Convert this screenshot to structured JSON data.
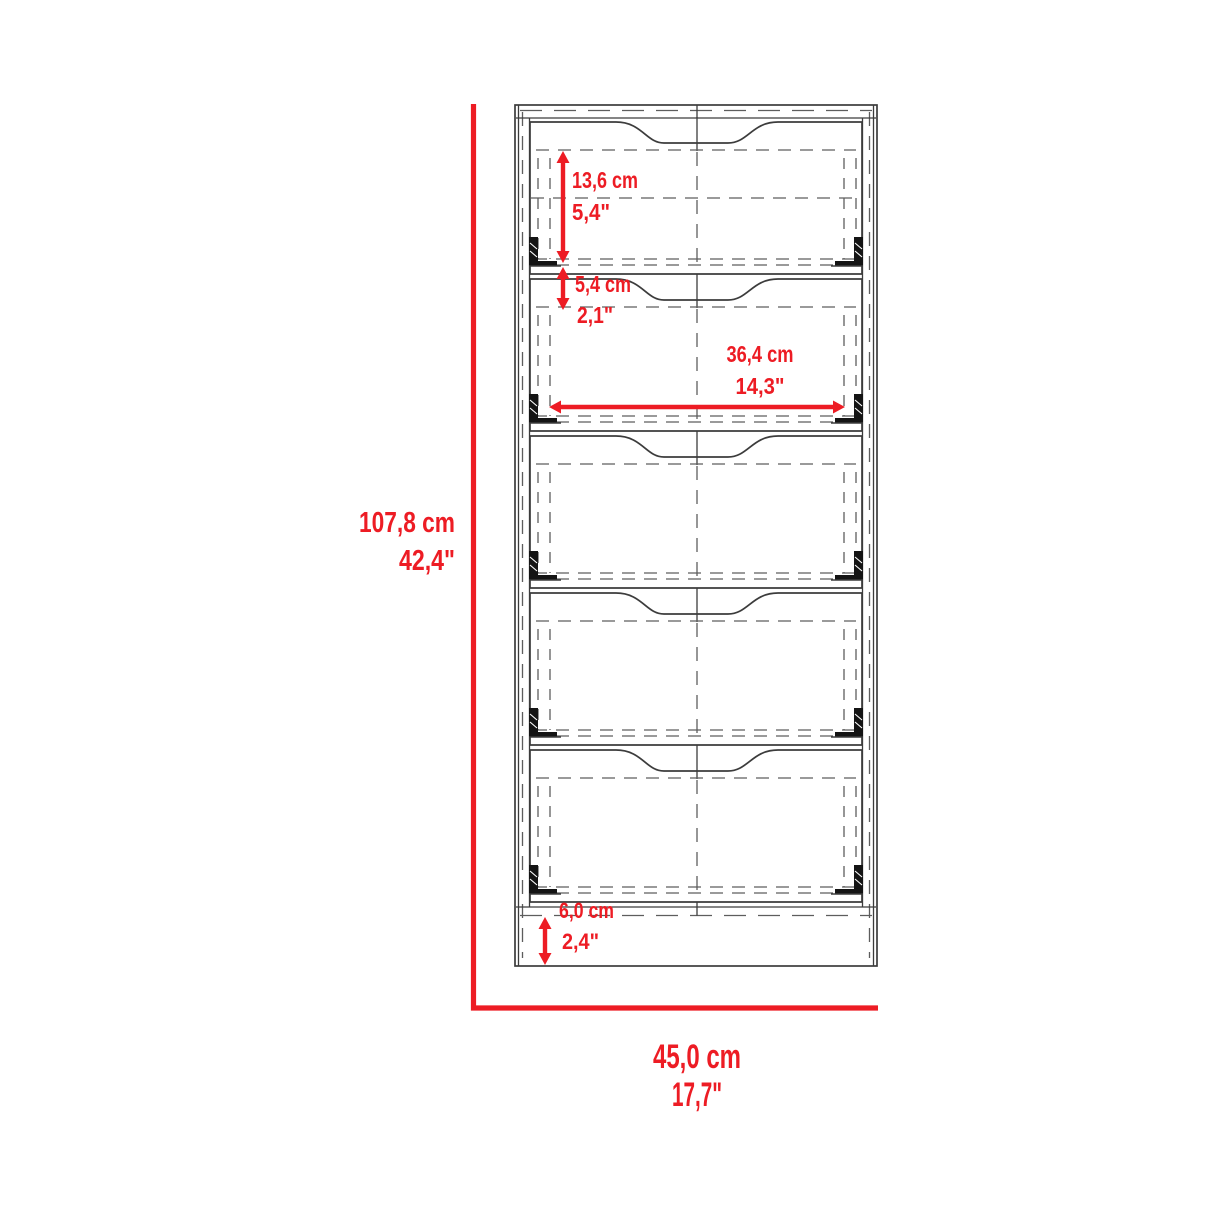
{
  "drawing": {
    "type": "furniture dimensional drawing",
    "subject": "five-drawer tall cabinet, front elevation",
    "drawer_count": 5
  },
  "colors": {
    "dimension_red": "#ed1c24",
    "line_dark": "#3c3c3c",
    "line_dashed": "#5d5d5d",
    "background": "#ffffff"
  },
  "dimensions": {
    "overall_height": {
      "metric": "107,8 cm",
      "imperial": "42,4\""
    },
    "overall_width": {
      "metric": "45,0 cm",
      "imperial": "17,7\""
    },
    "top_drawer_height": {
      "metric": "13,6 cm",
      "imperial": "5,4\""
    },
    "drawer_spacing": {
      "metric": "5,4 cm",
      "imperial": "2,1\""
    },
    "drawer_inner_width": {
      "metric": "36,4 cm",
      "imperial": "14,3\""
    },
    "base_height": {
      "metric": "6,0 cm",
      "imperial": "2,4\""
    }
  }
}
